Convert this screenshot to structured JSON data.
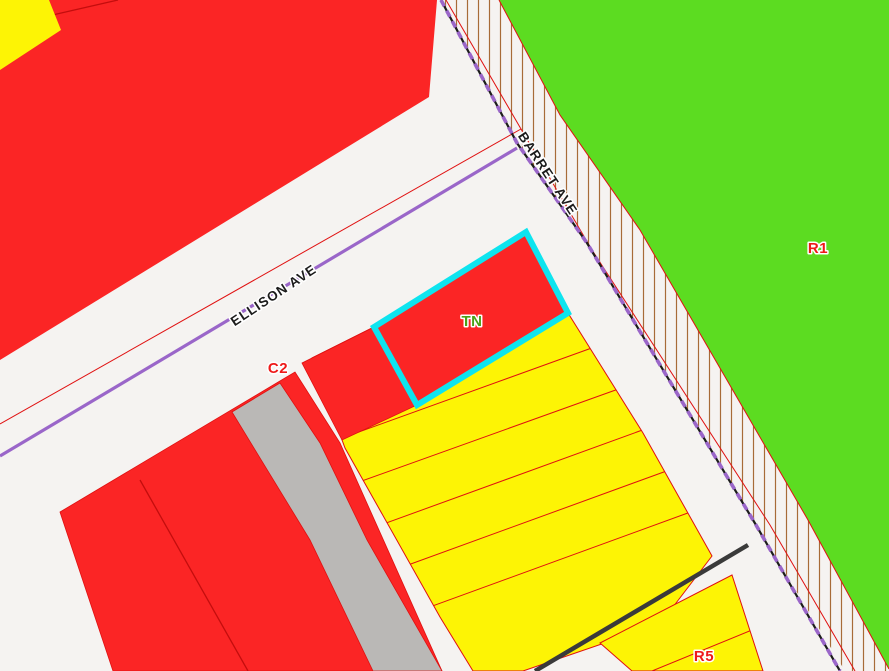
{
  "map": {
    "streets": {
      "ellison_ave": {
        "label": "ELLISON AVE"
      },
      "barret_ave": {
        "label": "BARRET AVE"
      }
    },
    "zones": {
      "c2": {
        "label": "C2"
      },
      "tn": {
        "label": "TN"
      },
      "r1": {
        "label": "R1"
      },
      "r5": {
        "label": "R5"
      }
    },
    "selection": {
      "selected_zone": "TN",
      "highlight_color": "#0ee4ef"
    },
    "colors": {
      "street_bg": "#f5f3f1",
      "zone_red": "#fb2525",
      "zone_yellow": "#fdf405",
      "zone_green": "#5cdc21",
      "zone_gray": "#bab8b6",
      "selection_cyan": "#0ee4ef",
      "centerline_purple": "#9a66c9",
      "parcel_line_red": "#e01010",
      "boundary_dark_red": "#c40d0d",
      "hatch_brown": "#a76b38",
      "street_line_black": "#3a3a3a",
      "dash_black": "#1c1c1c",
      "label_red": "#ee1a1a",
      "label_green": "#4aa016",
      "street_label_black": "#1c1c1c"
    }
  }
}
